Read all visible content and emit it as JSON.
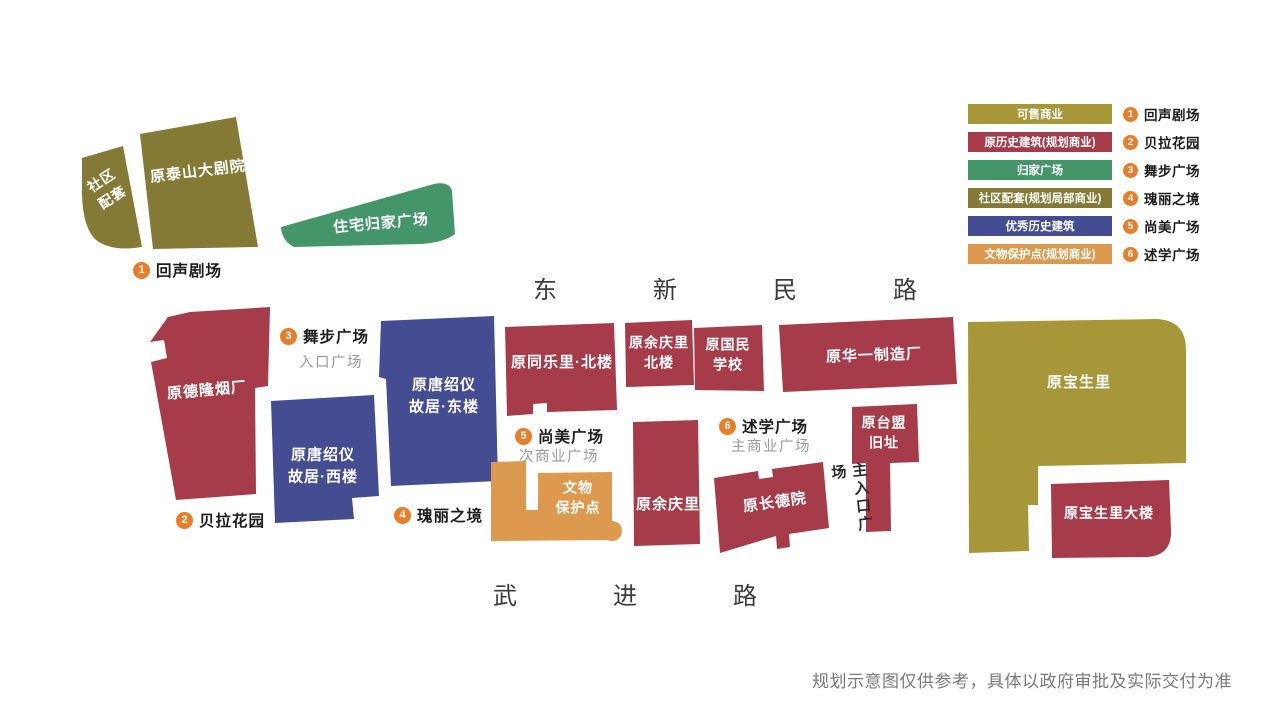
{
  "colors": {
    "saleable": "#a79739",
    "historic": "#a63c49",
    "homecoming": "#44966a",
    "community": "#847a35",
    "heritage": "#454d92",
    "relic": "#dd9a4e",
    "marker": "#e87d2a",
    "road-text": "#3c3c3c",
    "sub-label": "#9b9b9b",
    "disclaimer": "#7a7a7a"
  },
  "legend": {
    "categories": [
      {
        "label": "可售商业",
        "color": "saleable"
      },
      {
        "label": "原历史建筑(规划商业)",
        "color": "historic"
      },
      {
        "label": "归家广场",
        "color": "homecoming"
      },
      {
        "label": "社区配套(规划局部商业)",
        "color": "community"
      },
      {
        "label": "优秀历史建筑",
        "color": "heritage"
      },
      {
        "label": "文物保护点(规划商业)",
        "color": "relic"
      }
    ],
    "numbered": [
      {
        "num": "1",
        "label": "回声剧场"
      },
      {
        "num": "2",
        "label": "贝拉花园"
      },
      {
        "num": "3",
        "label": "舞步广场"
      },
      {
        "num": "4",
        "label": "瑰丽之境"
      },
      {
        "num": "5",
        "label": "尚美广场"
      },
      {
        "num": "6",
        "label": "述学广场"
      }
    ]
  },
  "roads": {
    "north": "东新民路",
    "south": "武进路"
  },
  "buildings": {
    "community_annex": "社区\n配套",
    "taishan_theatre": "原泰山大剧院",
    "homecoming_plaza": "住宅归家广场",
    "delong_tobacco": "原德隆烟厂",
    "tang_west": "原唐绍仪\n故居·西楼",
    "tang_east": "原唐绍仪\n故居·东楼",
    "tongleli_north": "原同乐里·北楼",
    "yuqingli_north": "原余庆里\n北楼",
    "guomin_school": "原国民\n学校",
    "huayi_factory": "原华一制造厂",
    "relic_point": "文物\n保护点",
    "yuqingli": "原余庆里",
    "changdeyuan": "原长德院",
    "taimeng_site": "原台盟\n旧址",
    "baoshengli": "原宝生里",
    "baoshengli_tower": "原宝生里大楼"
  },
  "markers": [
    {
      "num": "1",
      "label": "回声剧场",
      "sub": ""
    },
    {
      "num": "2",
      "label": "贝拉花园",
      "sub": ""
    },
    {
      "num": "3",
      "label": "舞步广场",
      "sub": "入口广场"
    },
    {
      "num": "4",
      "label": "瑰丽之境",
      "sub": ""
    },
    {
      "num": "5",
      "label": "尚美广场",
      "sub": "次商业广场"
    },
    {
      "num": "6",
      "label": "述学广场",
      "sub": "主商业广场"
    }
  ],
  "plaza_labels": {
    "main_entrance": "主入口广场"
  },
  "disclaimer": "规划示意图仅供参考，具体以政府审批及实际交付为准"
}
